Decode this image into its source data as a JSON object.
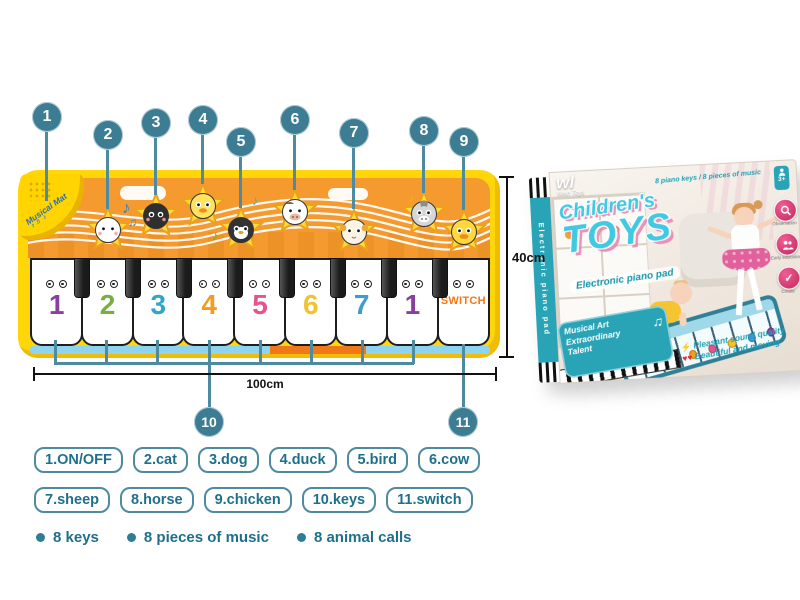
{
  "colors": {
    "callout_circle": "#3d7d93",
    "leader_line": "#4e8aa0",
    "legend_text": "#1f6f8c",
    "mat_yellow": "#ffd60a",
    "banner_orange": "#f59a2e",
    "strip_blue": "#8ed4ef",
    "strip_orange": "#f07818",
    "box_teal": "#29a4b6",
    "title_cyan": "#3fc9e3",
    "badge_pink": "#d6336c"
  },
  "mat": {
    "speaker_label": "Musical Mat",
    "speaker_notes": "♪ ♬ ♪",
    "animals": [
      {
        "name": "cat",
        "face": "#ffffff"
      },
      {
        "name": "dog",
        "face": "#2f2f2f"
      },
      {
        "name": "duck",
        "face": "#ffe25e"
      },
      {
        "name": "bird",
        "face": "#333333"
      },
      {
        "name": "cow",
        "face": "#ffffff"
      },
      {
        "name": "sheep",
        "face": "#fdf3e3"
      },
      {
        "name": "horse",
        "face": "#d6d6d6"
      },
      {
        "name": "chicken",
        "face": "#ffd83d"
      }
    ],
    "keys": [
      {
        "label": "1",
        "color": "#8a3f9e"
      },
      {
        "label": "2",
        "color": "#76b043"
      },
      {
        "label": "3",
        "color": "#2fa8c5"
      },
      {
        "label": "4",
        "color": "#f59b1e"
      },
      {
        "label": "5",
        "color": "#e8538f"
      },
      {
        "label": "6",
        "color": "#f2c230"
      },
      {
        "label": "7",
        "color": "#3f9ad6"
      },
      {
        "label": "1",
        "color": "#8a3f9e"
      },
      {
        "label": "SWITCH",
        "color": "#f07818"
      }
    ],
    "notes": [
      {
        "glyph": "♪",
        "color": "#2f86c8"
      },
      {
        "glyph": "♫",
        "color": "#2f86c8"
      },
      {
        "glyph": "♪",
        "color": "#6db52e"
      },
      {
        "glyph": "♪",
        "color": "#37b3d9"
      },
      {
        "glyph": "♪",
        "color": "#e8b514"
      }
    ]
  },
  "callouts": [
    {
      "n": "1"
    },
    {
      "n": "2"
    },
    {
      "n": "3"
    },
    {
      "n": "4"
    },
    {
      "n": "5"
    },
    {
      "n": "6"
    },
    {
      "n": "7"
    },
    {
      "n": "8"
    },
    {
      "n": "9"
    },
    {
      "n": "10"
    },
    {
      "n": "11"
    }
  ],
  "dimensions": {
    "width": "100cm",
    "height": "40cm"
  },
  "legend": {
    "items": [
      "1.ON/OFF",
      "2.cat",
      "3.dog",
      "4.duck",
      "5.bird",
      "6.cow",
      "7.sheep",
      "8.horse",
      "9.chicken",
      "10.keys",
      "11.switch"
    ]
  },
  "features": [
    "8 keys",
    "8 pieces of music",
    "8 animal calls"
  ],
  "box": {
    "logo": "wl",
    "logo_sub": "Wein Toys",
    "title_line1": "Children's",
    "title_line2": "TOYS",
    "subtitle": "Electronic piano pad",
    "top_slogan": "8 piano keys / 8 pieces of music",
    "age_badge": "3+",
    "badges": [
      {
        "icon": "magnifier-icon",
        "label": "Observation"
      },
      {
        "icon": "people-icon",
        "label": "Early education"
      },
      {
        "icon": "check-icon",
        "label": "Create"
      }
    ],
    "corner_badge_line1": "Musical Art",
    "corner_badge_line2": "Extraordinary",
    "corner_badge_line3": "Talent",
    "corner_badge_note": "♫",
    "slogan_line1": "Pleasant sound quality",
    "slogan_line2": "Beautiful and moving",
    "spine_text": "Electronic piano pad"
  }
}
